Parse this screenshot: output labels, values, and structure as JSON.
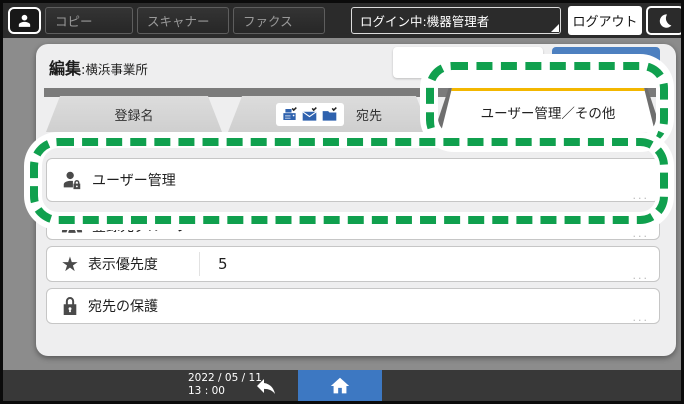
{
  "topbar": {
    "apps": [
      {
        "label": "コピー"
      },
      {
        "label": "スキャナー"
      },
      {
        "label": "ファクス"
      }
    ],
    "login_status": "ログイン中:機器管理者",
    "logout_label": "ログアウト"
  },
  "panel": {
    "title": "編集",
    "title_separator": ":",
    "title_value": "横浜事業所",
    "cancel_label": "取消",
    "ok_label": "OK",
    "more_label": "...",
    "tabs": [
      {
        "label": "登録名",
        "active": false
      },
      {
        "label": "宛先",
        "active": false,
        "icons": [
          "fax-icon",
          "mail-icon",
          "folder-icon"
        ]
      },
      {
        "label": "ユーザー管理／その他",
        "active": true
      }
    ],
    "rows": [
      {
        "icon": "user-lock-icon",
        "label": "ユーザー管理"
      },
      {
        "icon": "groups-icon",
        "label": "登録先グループ"
      },
      {
        "icon": "star-icon",
        "label": "表示優先度",
        "value": "5"
      },
      {
        "icon": "lock-icon",
        "label": "宛先の保護"
      }
    ],
    "star_glyph": "★"
  },
  "bottombar": {
    "date": "2022 / 05 / 11",
    "time": "13 : 00"
  },
  "annotation": {
    "highlight_color": "#10a04e",
    "highlighted_items": [
      "tab-user-management",
      "row-user-management"
    ]
  },
  "colors": {
    "accent_blue": "#4d80c0",
    "home_blue": "#3d78c2",
    "active_tab_stripe": "#f3b700",
    "panel_bg": "#eeeeef",
    "topbar_bg": "#2b2b2b"
  }
}
